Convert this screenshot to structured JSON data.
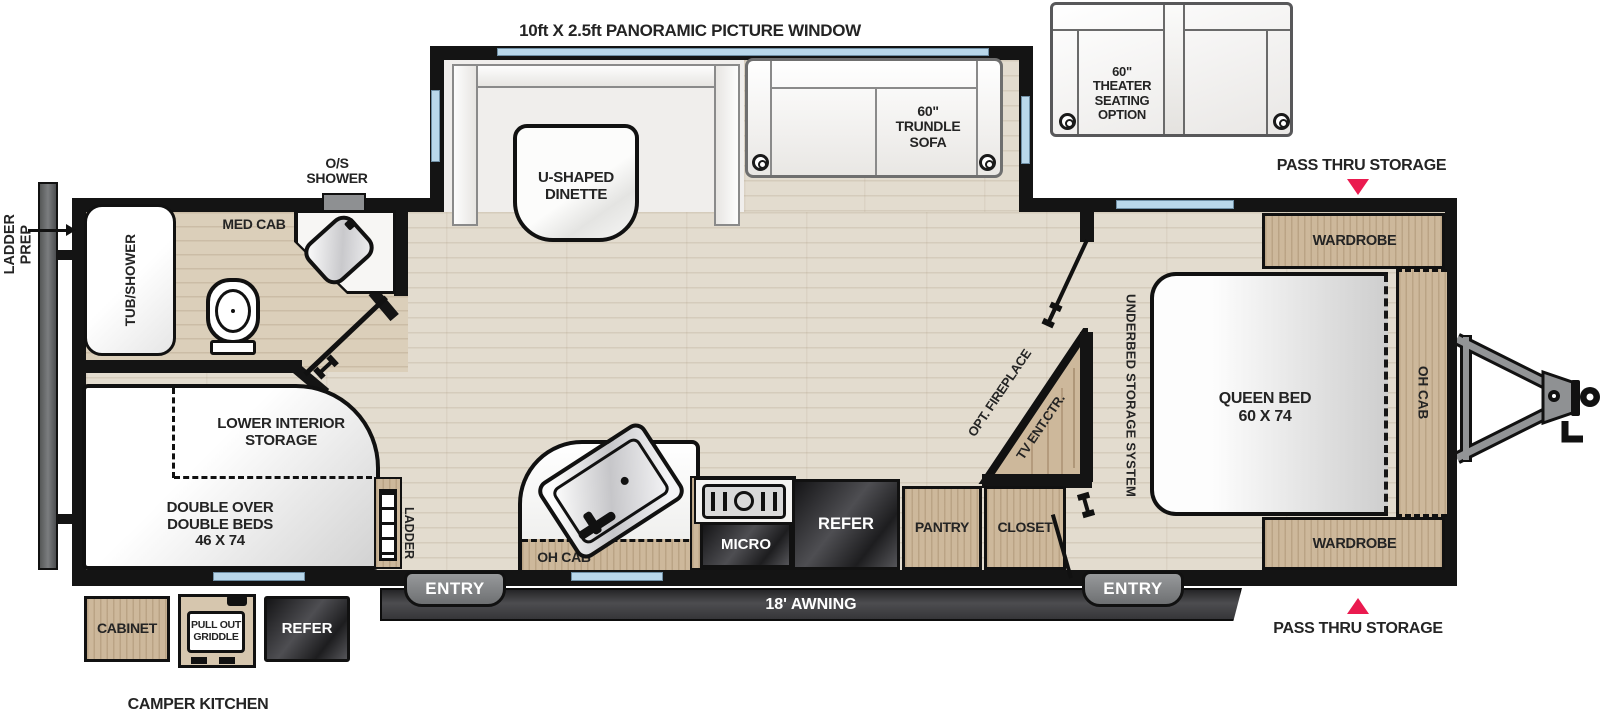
{
  "title": {
    "panoramic_window": "10ft X 2.5ft PANORAMIC PICTURE WINDOW"
  },
  "colors": {
    "wall": "#141414",
    "wood": "#cdb89b",
    "floor": "#e3dccf",
    "bath_floor": "#dbcfba",
    "window_blue": "#b9d7ea",
    "accent_red": "#ea1a4f",
    "appliance_dark": "#2e2e30",
    "awning_dark": "#3a3a3d",
    "exterior_gray": "#8f9193"
  },
  "slideout": {
    "dinette": "U-SHAPED\nDINETTE",
    "trundle_sofa": "60\"\nTRUNDLE\nSOFA"
  },
  "options": {
    "theater_seating": "60\"\nTHEATER\nSEATING\nOPTION"
  },
  "storage": {
    "pass_thru_top": "PASS THRU STORAGE",
    "pass_thru_bottom": "PASS THRU STORAGE",
    "underbed": "UNDERBED STORAGE SYSTEM",
    "lower_interior": "LOWER INTERIOR\nSTORAGE"
  },
  "bedroom": {
    "wardrobe_top": "WARDROBE",
    "wardrobe_bottom": "WARDROBE",
    "queen_bed": "QUEEN BED\n60 X 74",
    "oh_cab": "OH CAB"
  },
  "living": {
    "opt_fireplace": "OPT. FIREPLACE",
    "tv_ent_ctr": "TV ENT.CTR."
  },
  "kitchen": {
    "oh_cab": "OH CAB",
    "micro": "MICRO",
    "refer": "REFER",
    "pantry": "PANTRY",
    "closet": "CLOSET"
  },
  "bathroom": {
    "tub_shower": "TUB/SHOWER",
    "med_cab": "MED CAB",
    "os_shower": "O/S\nSHOWER"
  },
  "bunk": {
    "beds": "DOUBLE OVER\nDOUBLE BEDS\n46 X 74",
    "ladder": "LADDER"
  },
  "exterior": {
    "ladder_prep": "LADDER\nPREP",
    "entry_left": "ENTRY",
    "entry_right": "ENTRY",
    "awning": "18' AWNING"
  },
  "camper_kitchen": {
    "title": "CAMPER KITCHEN",
    "cabinet": "CABINET",
    "pull_out_griddle": "PULL OUT\nGRIDDLE",
    "refer": "REFER"
  }
}
